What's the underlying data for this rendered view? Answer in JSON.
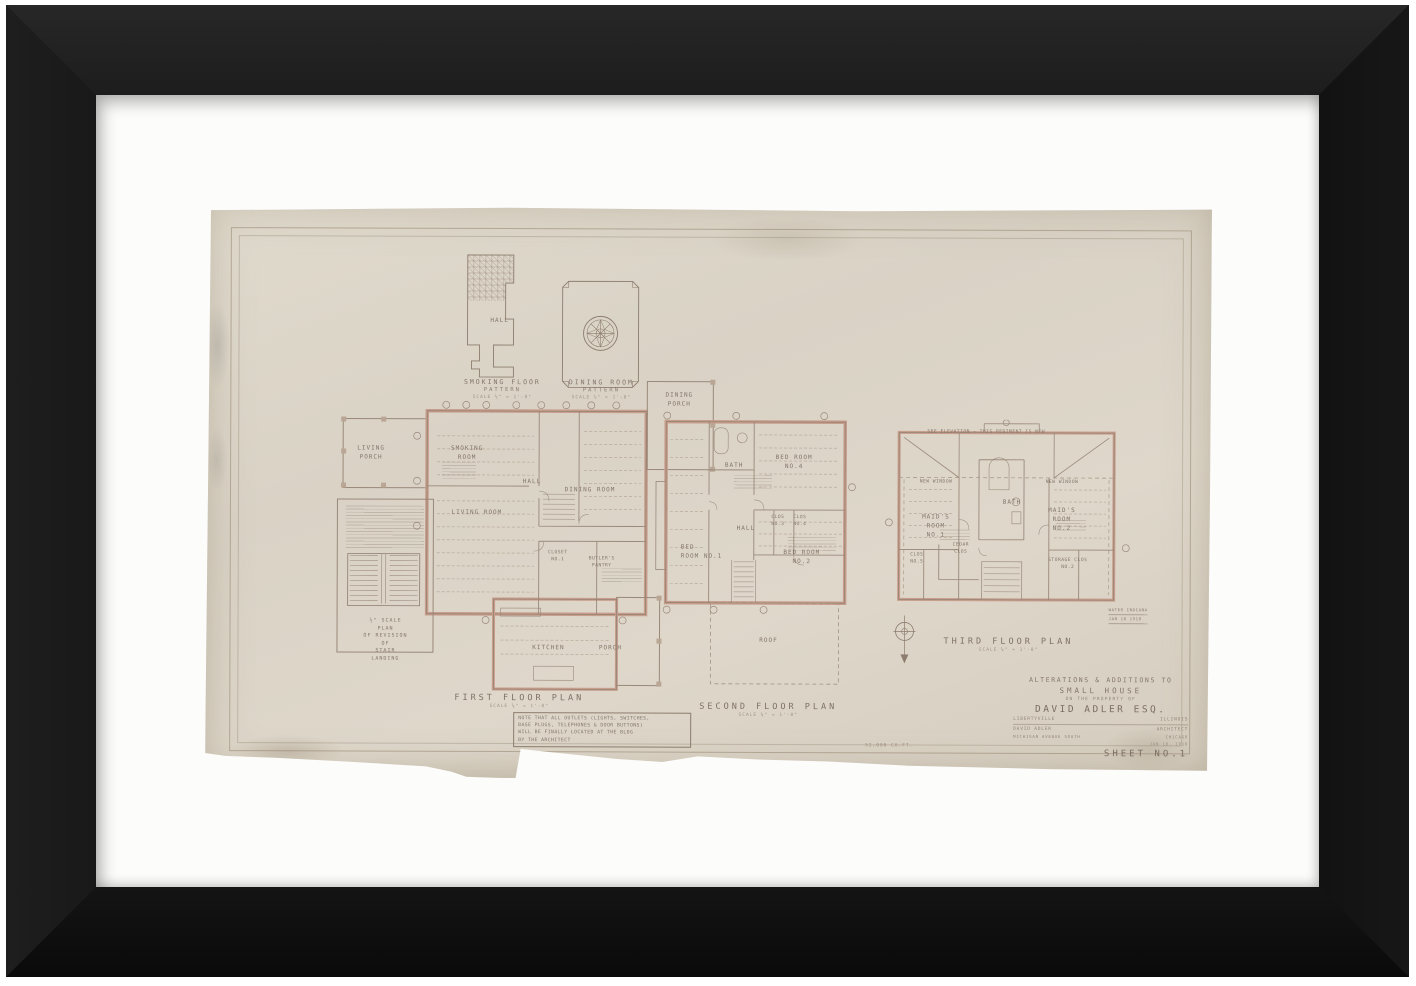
{
  "patterns": {
    "smoking": {
      "room": "HALL",
      "title1": "SMOKING FLOOR",
      "title2": "PATTERN",
      "scale": "SCALE ½\" = 1'-0\""
    },
    "dining": {
      "title1": "DINING ROOM",
      "title2": "PATTERN",
      "scale": "SCALE ½\" = 1'-0\""
    }
  },
  "first_floor": {
    "title": "FIRST FLOOR PLAN",
    "scale": "SCALE ¼\" = 1'-0\"",
    "rooms": {
      "living_porch": "LIVING\nPORCH",
      "smoking_room": "SMOKING\nROOM",
      "living_room": "LIVING ROOM",
      "hall": "HALL",
      "dining_room": "DINING ROOM",
      "dining_porch": "DINING\nPORCH",
      "closet1": "CLOSET\nNO.1",
      "butlers_pantry": "BUTLER'S\nPANTRY",
      "kitchen": "KITCHEN",
      "porch": "PORCH"
    },
    "stair_detail": "½\" SCALE PLAN\nOF REVISION OF\nSTAIR LANDING"
  },
  "second_floor": {
    "title": "SECOND FLOOR PLAN",
    "scale": "SCALE ¼\" = 1'-0\"",
    "rooms": {
      "bedroom1": "BED\nROOM NO.1",
      "bath": "BATH",
      "bedroom4": "BED ROOM\nNO.4",
      "hall": "HALL",
      "clos3": "CLOS\nNO.3",
      "clos4": "CLOS\nNO.4",
      "bedroom2": "BED ROOM\nNO.2",
      "roof": "ROOF"
    }
  },
  "third_floor": {
    "title": "THIRD FLOOR PLAN",
    "scale": "SCALE ¼\" = 1'-0\"",
    "pediment_note": "SEE ELEVATION — THIS PEDIMENT IS NEW",
    "rooms": {
      "new_window_left": "NEW WINDOW",
      "new_window_right": "NEW WINDOW",
      "maids1": "MAID'S\nROOM\nNO.1",
      "bath": "BATH",
      "maids2": "MAID'S\nROOM\nNO.2",
      "cedar": "CEDAR\nCLOS",
      "clos5": "CLOS\nNO.5",
      "storage": "STORAGE CLOS\nNO.2"
    }
  },
  "note_box": "NOTE THAT ALL OUTLETS (LIGHTS, SWITCHES,\nBASE PLUGS, TELEPHONES & DOOR BUTTONS)\nWILL BE FINALLY LOCATED AT THE BLDG\nBY THE ARCHITECT",
  "title_block": {
    "line1": "ALTERATIONS & ADDITIONS TO",
    "line2": "SMALL HOUSE",
    "line3": "ON THE PROPERTY OF",
    "name": "DAVID ADLER ESQ.",
    "city": "LIBERTYVILLE",
    "state": "ILLINOIS",
    "architect_name": "DAVID ADLER",
    "architect_title": "ARCHITECT",
    "address": "MICHIGAN AVENUE SOUTH",
    "address_city": "CHICAGO",
    "date": "JAN 18, 1918",
    "sheet": "SHEET NO.1"
  },
  "annotations": {
    "cuft": "52,000 CU.FT.",
    "stamp1": "WATER INDIANA",
    "stamp2": "JAN 18 1918"
  }
}
